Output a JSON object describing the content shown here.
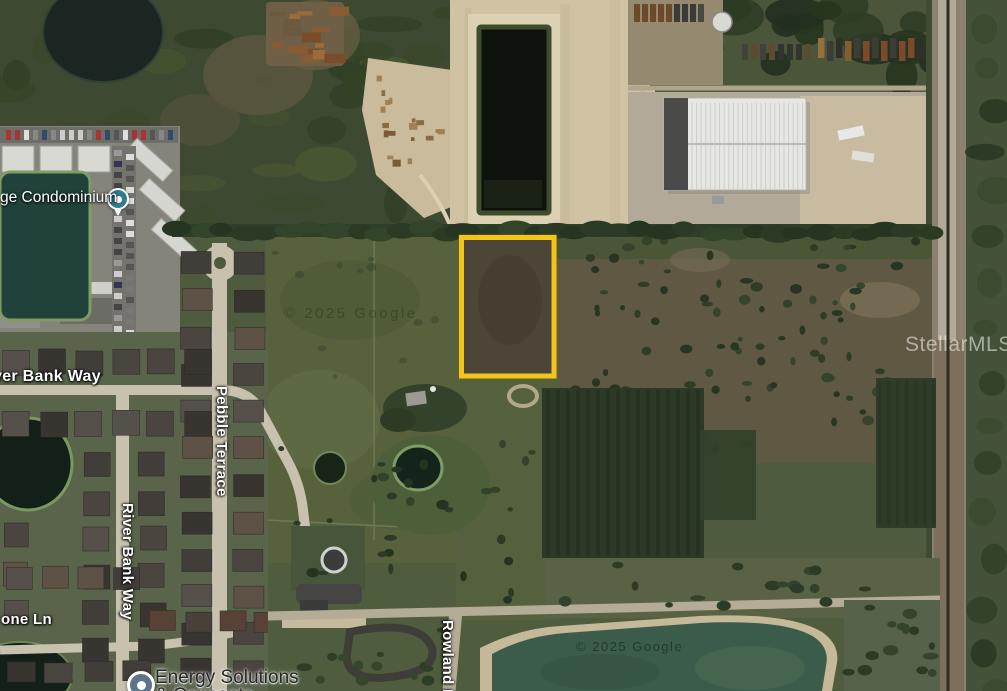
{
  "map": {
    "labels": {
      "condominium": "ge Condominium",
      "river_bank_way_horizontal": "ver Bank Way",
      "pebble_terrace": "Pebble Terrace",
      "river_bank_way_vertical": "River Bank Way",
      "one_ln": "one Ln",
      "energy_line1": "Energy Solutions",
      "energy_line2": "& Concepts",
      "rowland_dr": "Rowland Dr"
    },
    "watermarks": {
      "provider": "StellarMLS",
      "google_field": "© 2025 Google",
      "google_pond": "© 2025 Google"
    },
    "colors": {
      "parcel_outline": "#F2C51D",
      "condo_pin": "#2E7D8C",
      "energy_pin": "#5E7488"
    }
  }
}
